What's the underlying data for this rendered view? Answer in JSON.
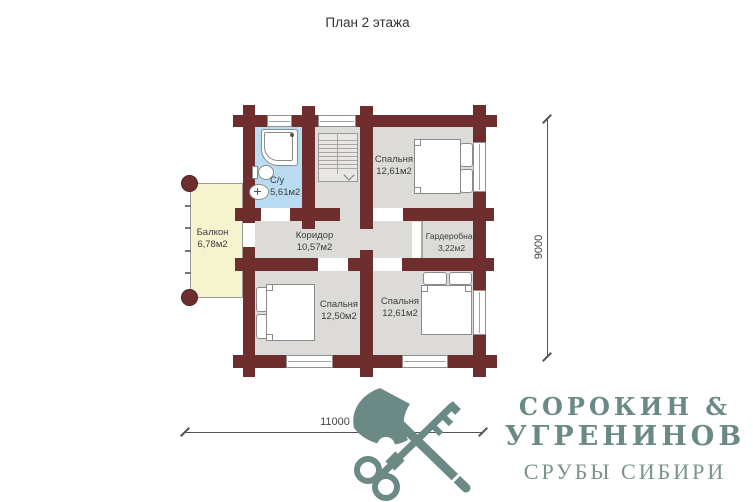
{
  "title": "План 2 этажа",
  "rooms": {
    "bathroom": {
      "name": "С/у",
      "area": "5,61м2"
    },
    "bedroom_top": {
      "name": "Спальня",
      "area": "12,61м2"
    },
    "balcony": {
      "name": "Балкон",
      "area": "6,78м2"
    },
    "corridor": {
      "name": "Коридор",
      "area": "10,57м2"
    },
    "wardrobe": {
      "name": "Гардеробная",
      "area": "3,22м2"
    },
    "bedroom_bottom_left": {
      "name": "Спальня",
      "area": "12,50м2"
    },
    "bedroom_bottom_right": {
      "name": "Спальня",
      "area": "12,61м2"
    }
  },
  "dimensions": {
    "horizontal": "11000",
    "vertical": "9000"
  },
  "logo": {
    "line1": "СОРОКИН &",
    "line2": "УГРЕНИНОВ",
    "line3": "СРУБЫ СИБИРИ"
  },
  "icons": {
    "logo_mark": "crossed-axe-and-key-icon"
  },
  "colors": {
    "wall": "#6f2e2e",
    "floor": "#dcdbd8",
    "bathroom": "#b9dcf3",
    "balcony": "#f6f3cf",
    "logo": "#6b8a86"
  }
}
